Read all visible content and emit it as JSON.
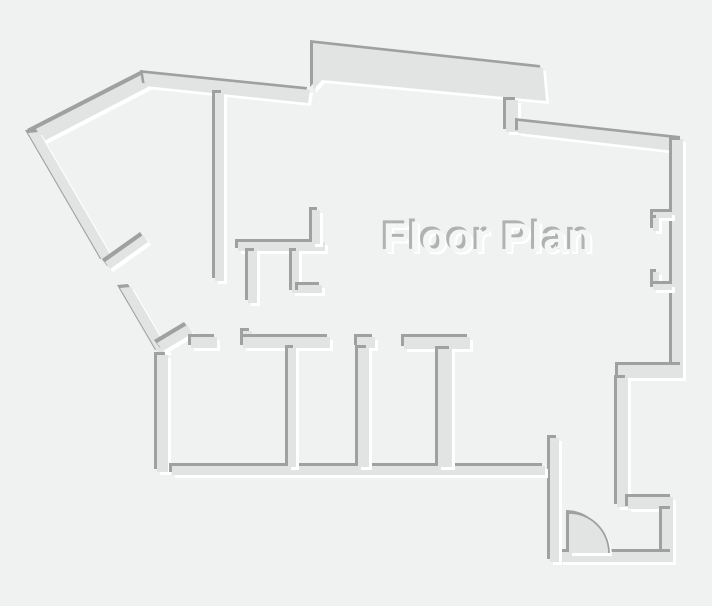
{
  "page": {
    "background": "#f0f1f1"
  },
  "title": {
    "text": "Floor Plan",
    "color": "#f4f5f5",
    "emboss_dark": "#b0b2b2",
    "emboss_light": "#ffffff"
  },
  "plan": {
    "wall_fill": "#e2e4e4",
    "edge_dark": "#9fa0a0",
    "edge_light": "#ffffff",
    "door_symbol": "quarter-circle-swing"
  }
}
